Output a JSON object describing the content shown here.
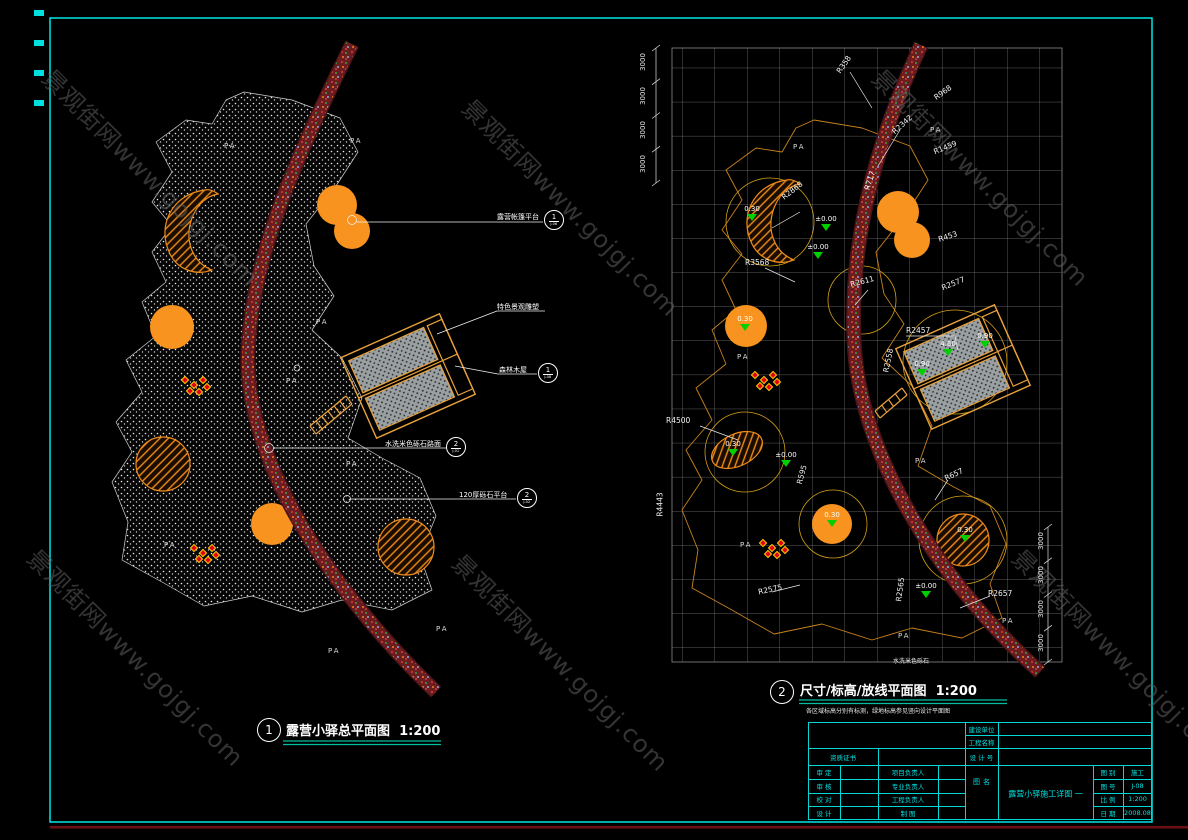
{
  "watermark": {
    "text": "景观街网www.gojgj.com"
  },
  "plan1": {
    "number": "1",
    "title": "露营小驿总平面图",
    "scale": "1:200",
    "pa": "PA",
    "callouts": {
      "tent": {
        "label": "露营帐篷平台",
        "num": "1",
        "ref": "J-06"
      },
      "sculpture": {
        "label": "特色景观雕塑"
      },
      "cabin": {
        "label": "森林木屋",
        "num": "1",
        "ref": "J-08"
      },
      "gravel": {
        "label": "水洗米色砾石路面",
        "num": "2",
        "ref": "J-01"
      },
      "platform": {
        "label": "120厚砾石平台",
        "num": "2",
        "ref": "J-02"
      }
    }
  },
  "plan2": {
    "number": "2",
    "title": "尺寸/标高/放线平面图",
    "scale": "1:200",
    "note": "各区域标高分别有标测，绿地标高参见竖向设计平面图",
    "dim": "3000",
    "pa": "PA",
    "gravel_label": "水洗米色砾石",
    "radius_labels": [
      "R358",
      "R2342",
      "R968",
      "R1459",
      "R717",
      "R2868",
      "R453",
      "R2577",
      "R3568",
      "R2611",
      "R2457",
      "R2558",
      "R4500",
      "R4443",
      "R595",
      "R2575",
      "R2565",
      "R2657",
      "R657"
    ],
    "elevations": [
      "0.30",
      "±0.00",
      "±0.00",
      "0.30",
      "0.30",
      "±0.00",
      "0.30",
      "4.60",
      "0.90",
      "0.90",
      "0.30",
      "±0.00"
    ]
  },
  "titleblock": {
    "client_label": "建设单位",
    "project_label": "工程名称",
    "cert_label": "资质证书",
    "designno_label": "设 计 号",
    "sign_rows": [
      {
        "l": "审 定",
        "m": "项目负责人"
      },
      {
        "l": "审 核",
        "m": "专业负责人"
      },
      {
        "l": "校 对",
        "m": "工程负责人"
      },
      {
        "l": "设 计",
        "m": "制  图"
      }
    ],
    "figname_label": "图 名",
    "drawing_name": "露营小驿施工详图 一",
    "meta": [
      {
        "l": "图 别",
        "v": "施工"
      },
      {
        "l": "图 号",
        "v": "J-08"
      },
      {
        "l": "比 例",
        "v": "1:200"
      },
      {
        "l": "日 期",
        "v": "2008.08"
      }
    ]
  }
}
